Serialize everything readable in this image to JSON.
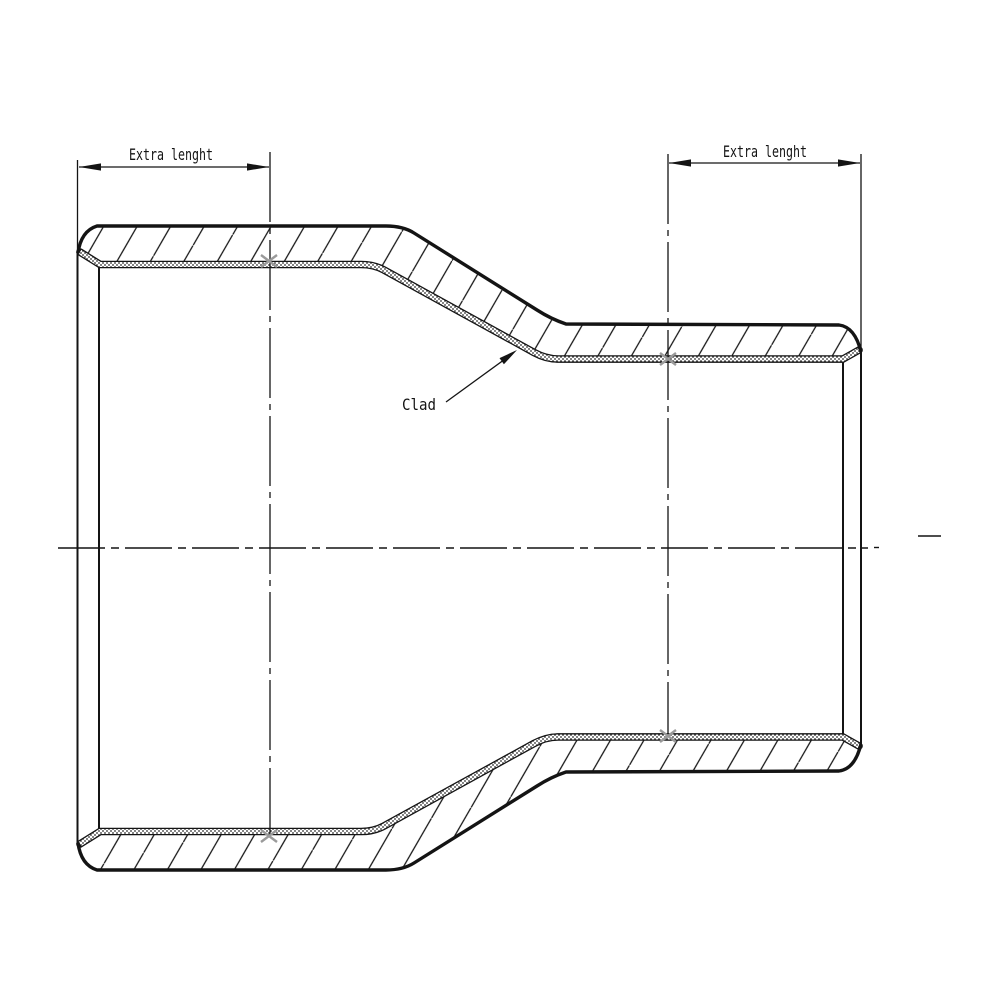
{
  "colors": {
    "line": "#141414",
    "background": "#ffffff",
    "clad_intersection_mark": "#9a9a9a"
  },
  "annotations": {
    "dim_left_label": "Extra lenght",
    "dim_right_label": "Extra lenght",
    "clad_label": "Clad"
  }
}
